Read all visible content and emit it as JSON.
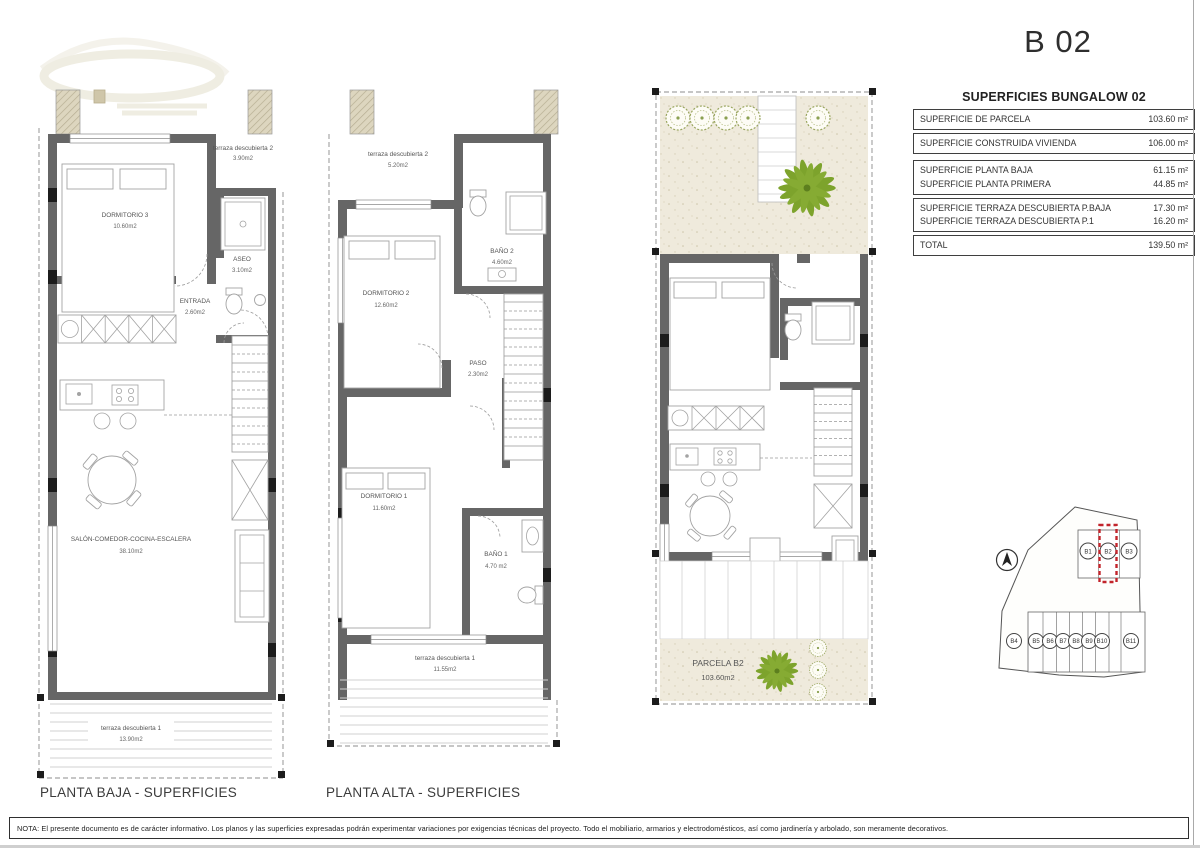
{
  "page": {
    "title": "B 02",
    "nota": "NOTA: El presente documento es de carácter informativo. Los planos y las superficies expresadas podrán experimentar variaciones por exigencias técnicas del proyecto. Todo el mobiliario, armarios y electrodomésticos, así como jardinería y arbolado, son meramente decorativos."
  },
  "table": {
    "title": "SUPERFICIES BUNGALOW 02",
    "groups": [
      {
        "rows": [
          {
            "label": "SUPERFICIE DE PARCELA",
            "value": "103.60 m²"
          }
        ]
      },
      {
        "rows": [
          {
            "label": "SUPERFICIE CONSTRUIDA VIVIENDA",
            "value": "106.00 m²"
          }
        ]
      },
      {
        "rows": [
          {
            "label": "SUPERFICIE PLANTA BAJA",
            "value": "61.15 m²"
          },
          {
            "label": "SUPERFICIE PLANTA PRIMERA",
            "value": "44.85 m²"
          }
        ]
      },
      {
        "rows": [
          {
            "label": "SUPERFICIE TERRAZA DESCUBIERTA P.BAJA",
            "value": "17.30 m²"
          },
          {
            "label": "SUPERFICIE TERRAZA DESCUBIERTA P.1",
            "value": "16.20 m²"
          }
        ]
      },
      {
        "rows": [
          {
            "label": "TOTAL",
            "value": "139.50 m²"
          }
        ]
      }
    ]
  },
  "plans": {
    "planta_baja": {
      "caption": "PLANTA BAJA - SUPERFICIES",
      "terraza2": {
        "name": "terraza descubierta 2",
        "area": "3.90m2"
      },
      "dormitorio3": {
        "name": "DORMITORIO 3",
        "area": "10.60m2"
      },
      "aseo": {
        "name": "ASEO",
        "area": "3.10m2"
      },
      "entrada": {
        "name": "ENTRADA",
        "area": "2.60m2"
      },
      "salon": {
        "name": "SALÓN-COMEDOR-COCINA-ESCALERA",
        "area": "38.10m2"
      },
      "terraza1": {
        "name": "terraza descubierta 1",
        "area": "13.90m2"
      }
    },
    "planta_alta": {
      "caption": "PLANTA ALTA - SUPERFICIES",
      "terraza2": {
        "name": "terraza descubierta 2",
        "area": "5.20m2"
      },
      "dormitorio2": {
        "name": "DORMITORIO 2",
        "area": "12.60m2"
      },
      "bano2": {
        "name": "BAÑO 2",
        "area": "4.60m2"
      },
      "paso": {
        "name": "PASO",
        "area": "2.30m2"
      },
      "dormitorio1": {
        "name": "DORMITORIO 1",
        "area": "11.60m2"
      },
      "bano1": {
        "name": "BAÑO 1",
        "area": "4.70 m2"
      },
      "terraza1": {
        "name": "terraza descubierta 1",
        "area": "11.55m2"
      }
    },
    "parcela": {
      "name": "PARCELA B2",
      "area": "103.60m2"
    }
  },
  "siteplan": {
    "lots": [
      "B1",
      "B2",
      "B3",
      "B4",
      "B5",
      "B6",
      "B7",
      "B8",
      "B9",
      "B10",
      "B11"
    ],
    "highlighted": "B2"
  },
  "colors": {
    "wall": "#666666",
    "pillar": "#1c1c1c",
    "party_wall_beige": "#ddd6bf",
    "ground_speckle": "#efeadc",
    "plant_green": "#7da32c",
    "highlight_red": "#c2242b"
  }
}
